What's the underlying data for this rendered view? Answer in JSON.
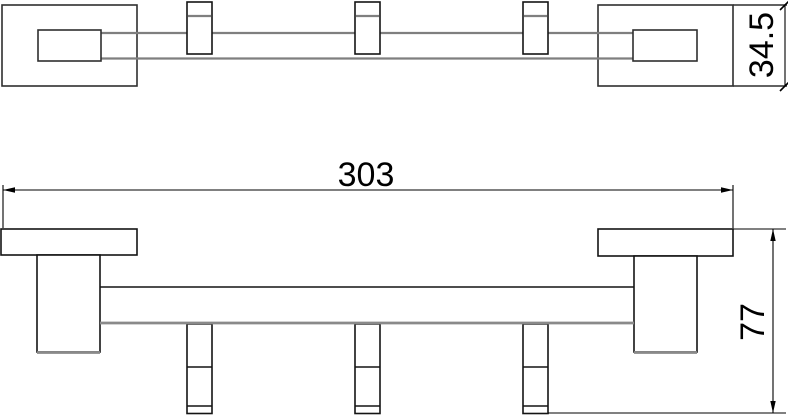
{
  "drawing": {
    "type": "technical-drawing",
    "description": "two-view CAD drawing of a wall-mounted rail with three hooks",
    "colors": {
      "background": "#ffffff",
      "outline": "#2f2f2f",
      "outline_dark": "#141414",
      "rail_gray": "#7f7f7f",
      "dimension_ink": "#000000"
    },
    "dimensions": {
      "overall_width": "303",
      "overall_height": "77",
      "end_plate_height": "34.5"
    }
  }
}
